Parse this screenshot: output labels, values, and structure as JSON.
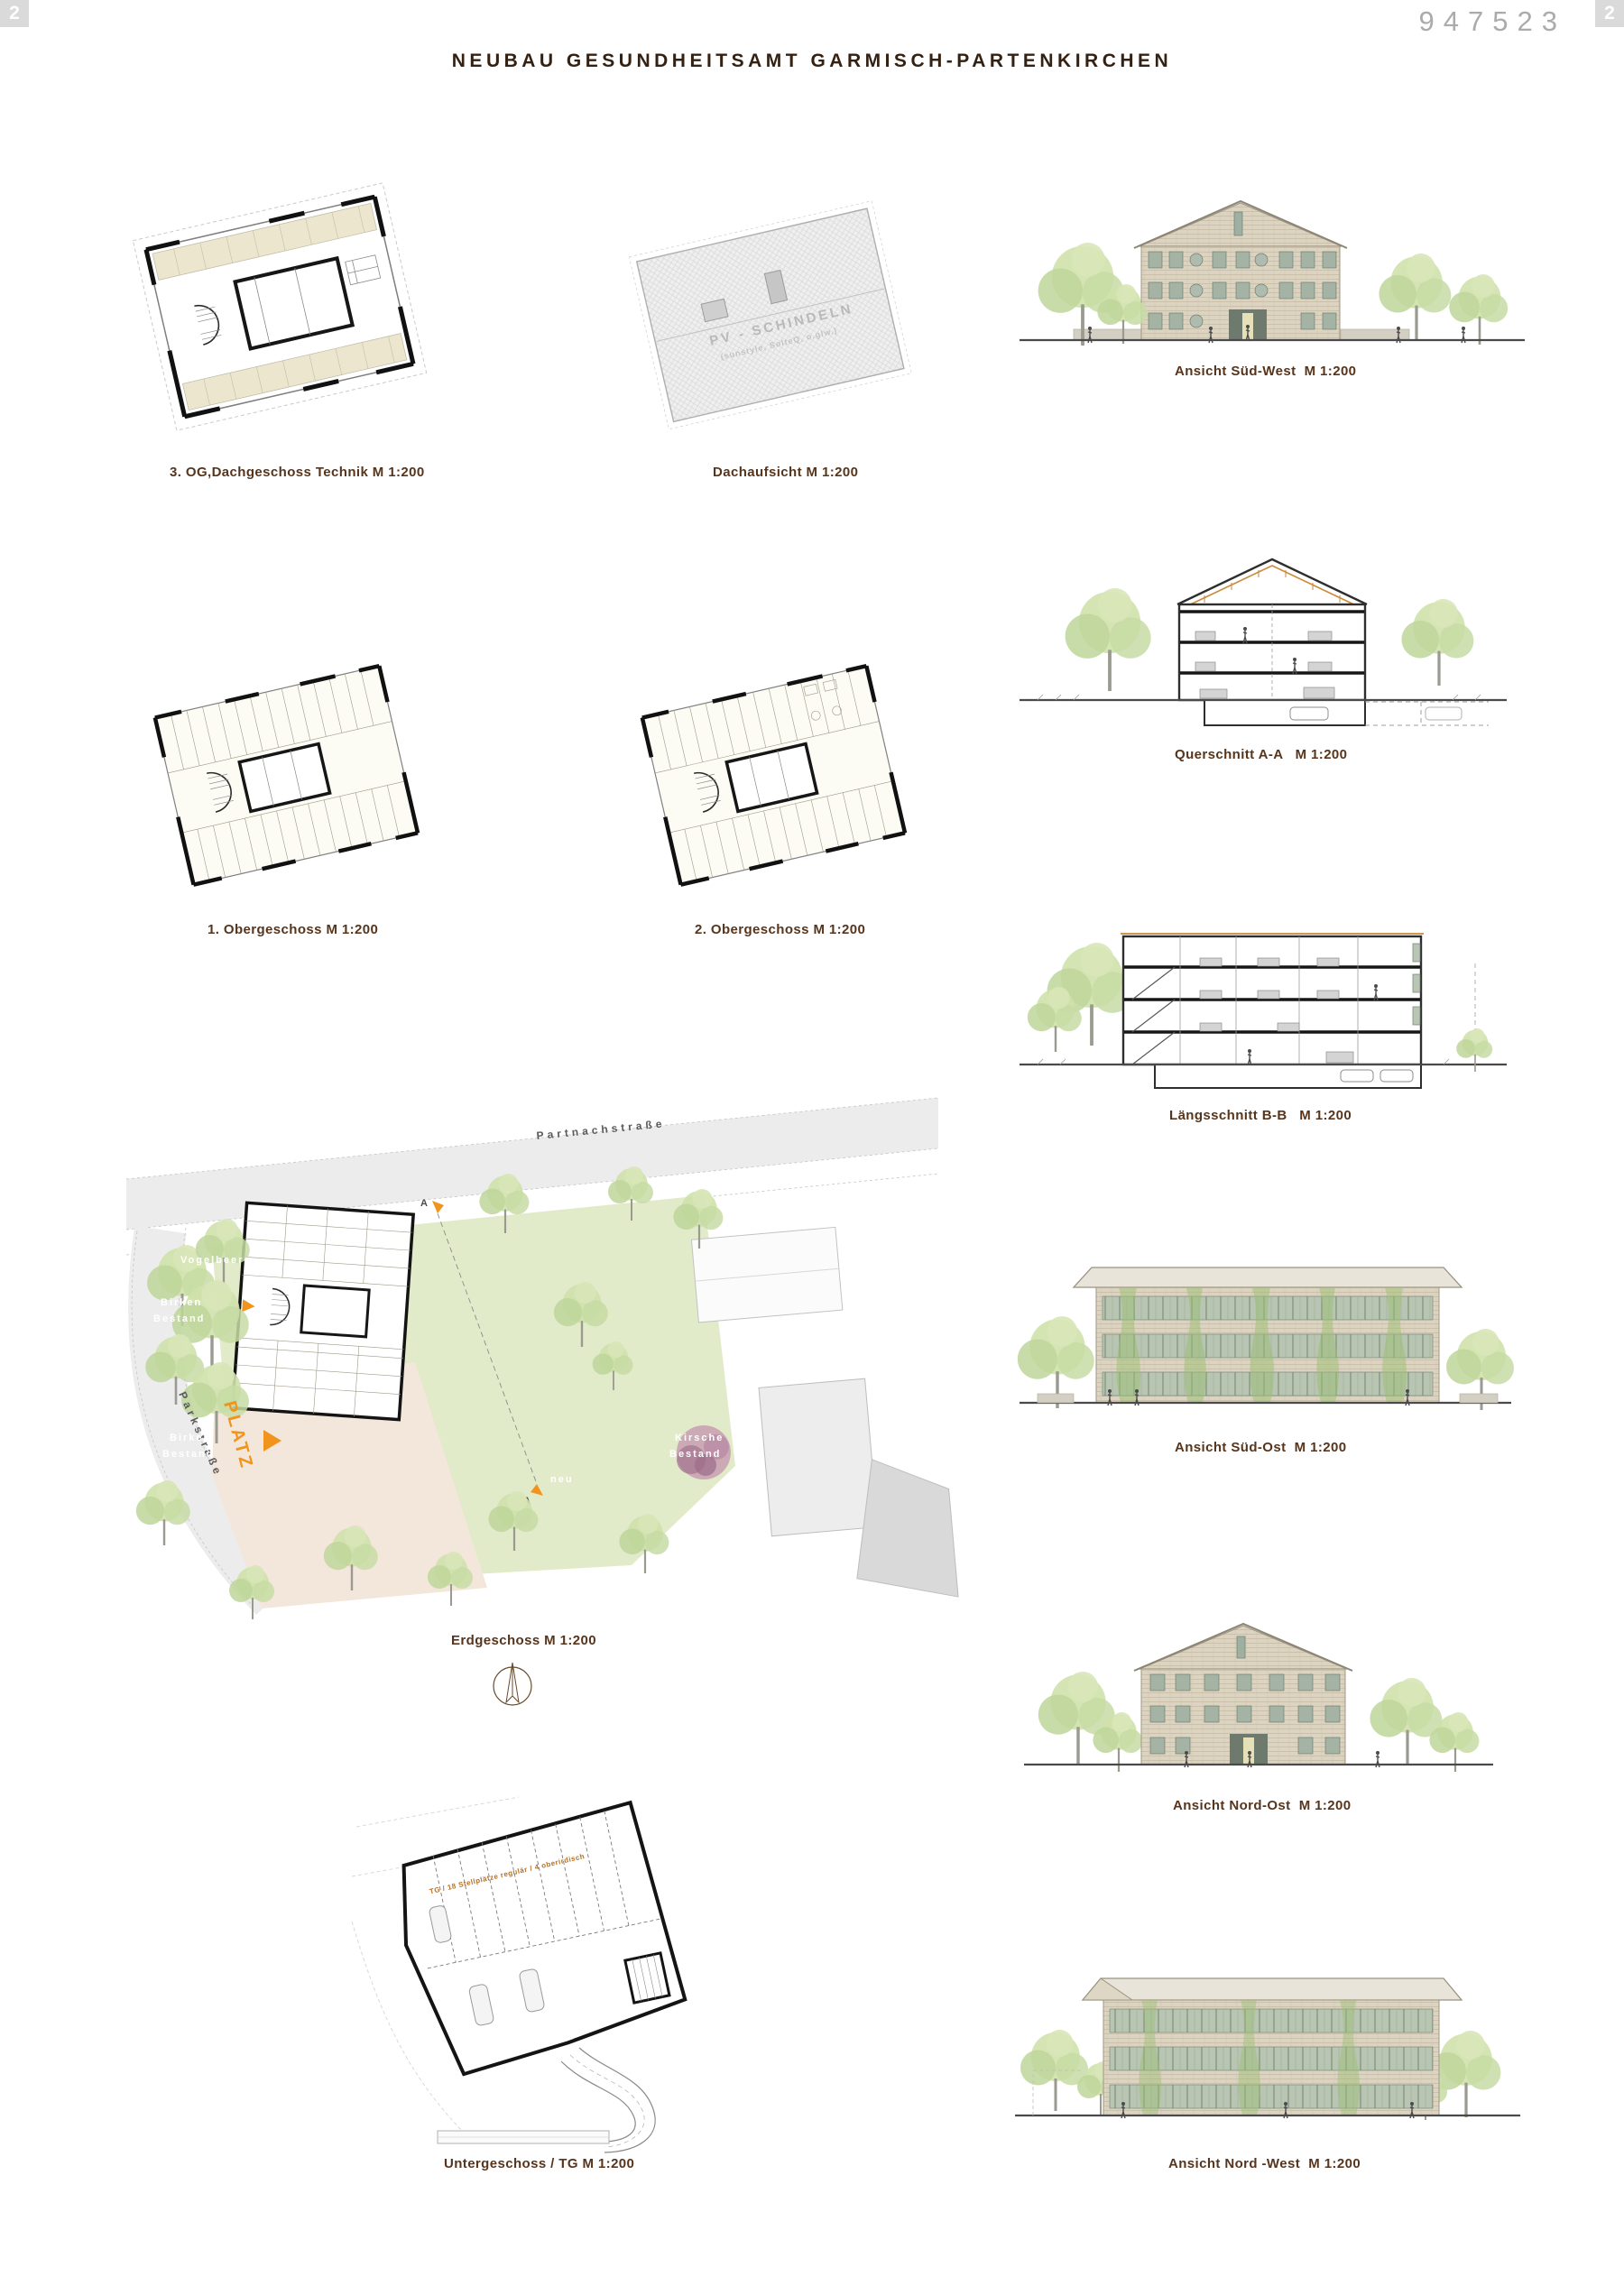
{
  "page": {
    "corner_badge_left": "2",
    "corner_badge_right": "2",
    "entry_number": "947523",
    "title": "NEUBAU GESUNDHEITSAMT GARMISCH-PARTENKIRCHEN"
  },
  "colors": {
    "caption_brown": "#57351c",
    "title_brown": "#342112",
    "entry_number_gray": "#ababab",
    "accent_orange": "#f0941e",
    "lawn_green": "#e0eac6",
    "plaza_beige": "#f3e6da",
    "roof_gray": "#efefef"
  },
  "captions": {
    "plan_3og": "3. OG,Dachgeschoss Technik M 1:200",
    "roof": "Dachaufsicht M 1:200",
    "elev_sw": "Ansicht Süd-West  M 1:200",
    "section_aa": "Querschnitt A-A   M 1:200",
    "plan_1og": "1. Obergeschoss M 1:200",
    "plan_2og": "2. Obergeschoss M 1:200",
    "section_bb": "Längsschnitt B-B   M 1:200",
    "elev_so": "Ansicht Süd-Ost  M 1:200",
    "site": "Erdgeschoss M 1:200",
    "elev_no": "Ansicht Nord-Ost  M 1:200",
    "plan_ug": "Untergeschoss / TG M 1:200",
    "elev_nw": "Ansicht Nord -West  M 1:200"
  },
  "roof_plan": {
    "label_line1": "PV - SCHINDELN",
    "label_line2": "(sunstyle, SolteQ, o.glw.)"
  },
  "site_plan": {
    "street_top": "Partnachstraße",
    "street_left": "Parkstraße",
    "plaza": "PLATZ",
    "vogelbeere": "Vogelbeere",
    "birken1_line1": "Birken",
    "birken1_line2": "Bestand",
    "birken2_line1": "Birken",
    "birken2_line2": "Bestand",
    "kirsche_line1": "Kirsche",
    "kirsche_line2": "Bestand",
    "neu": "neu",
    "section_letter_a_top": "A",
    "section_letter_a_bottom": "A"
  },
  "ug_plan": {
    "garage_label": "TG / 18 Stellplätze regulär / 4 oberirdisch"
  }
}
